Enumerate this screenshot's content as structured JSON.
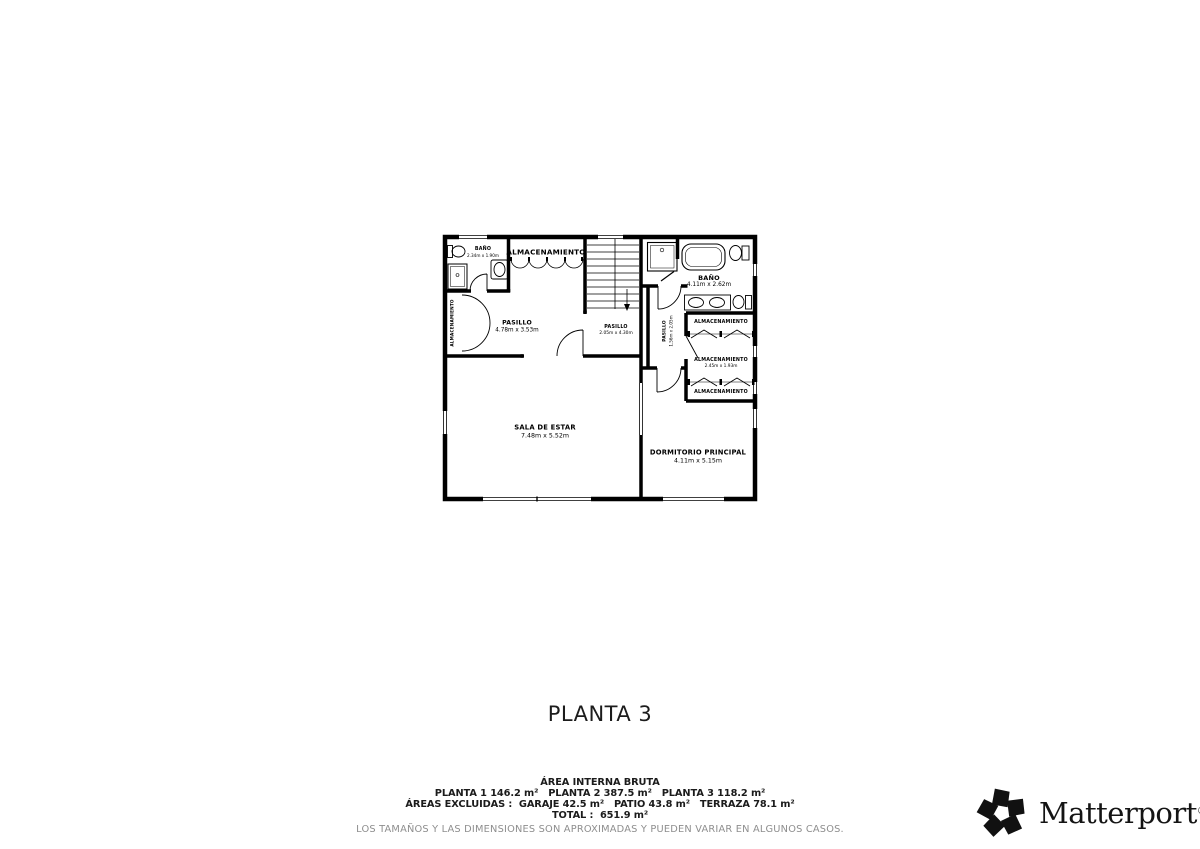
{
  "floor": {
    "title": "PLANTA 3",
    "rooms": {
      "banyo1": {
        "name": "BAÑO",
        "dims": "2.34m x 1.90m"
      },
      "alm_top": {
        "name": "ALMACENAMIENTO"
      },
      "alm_left": {
        "name": "ALMACENAMIENTO"
      },
      "pasillo_main": {
        "name": "PASILLO",
        "dims": "4.78m x 3.53m"
      },
      "pasillo_mid": {
        "name": "PASILLO",
        "dims": "2.05m x 4.30m"
      },
      "banyo2": {
        "name": "BAÑO",
        "dims": "4.11m x 2.62m"
      },
      "pasillo_small": {
        "name": "PASILLO",
        "dims": "1.56m x 2.05m"
      },
      "alm_r1": {
        "name": "ALMACENAMIENTO"
      },
      "alm_r2": {
        "name": "ALMACENAMIENTO",
        "dims": "2.45m x 1.93m"
      },
      "alm_r3": {
        "name": "ALMACENAMIENTO"
      },
      "sala": {
        "name": "SALA DE ESTAR",
        "dims": "7.48m x 5.52m"
      },
      "dormitorio": {
        "name": "DORMITORIO PRINCIPAL",
        "dims": "4.11m x 5.15m"
      }
    }
  },
  "summary": {
    "heading": "ÁREA INTERNA BRUTA",
    "line_plantas": "PLANTA 1 146.2 m²   PLANTA 2 387.5 m²   PLANTA 3 118.2 m²",
    "line_excluidas": "ÁREAS EXCLUIDAS :  GARAJE 42.5 m²   PATIO 43.8 m²   TERRAZA 78.1 m²",
    "line_total": "TOTAL :  651.9 m²",
    "disclaimer": "LOS TAMAÑOS Y LAS DIMENSIONES SON APROXIMADAS Y PUEDEN VARIAR EN ALGUNOS CASOS."
  },
  "brand": {
    "name": "Matterport",
    "registered": "®"
  },
  "colors": {
    "ink": "#000000",
    "muted": "#8e8e8e",
    "background": "#ffffff"
  }
}
